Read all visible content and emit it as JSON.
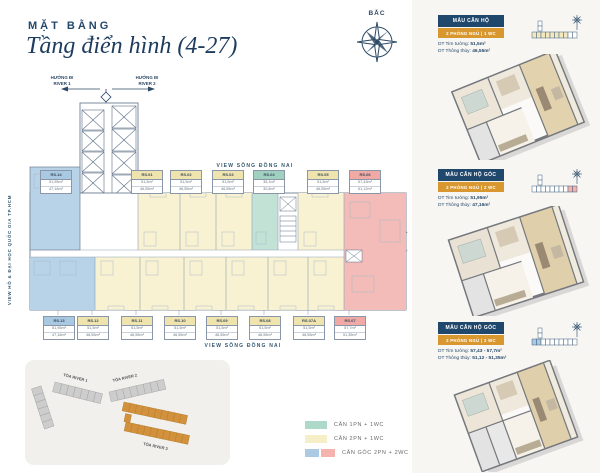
{
  "header": {
    "kicker": "MẶT BẰNG",
    "title": "Tầng điển hình (4-27)",
    "compass_label": "BẮC"
  },
  "plan": {
    "direction_left": {
      "line1": "HƯỚNG ĐI",
      "line2": "RIVER 1"
    },
    "direction_right": {
      "line1": "HƯỚNG ĐI",
      "line2": "RIVER 2"
    },
    "view_top": "VIEW SÔNG ĐỒNG NAI",
    "view_bottom": "VIEW SÔNG ĐỒNG NAI",
    "view_left": "VIEW HỒ & ĐẠI HỌC QUỐC GIA TP.HCM",
    "view_right": "VIEW SÔNG ĐỒNG NAI",
    "top_tags": [
      {
        "code": "RS.14",
        "area1": "51,95m²",
        "area2": "47,16m²",
        "type": "blue"
      },
      {
        "code": "RS.01",
        "area1": "51,5m²",
        "area2": "46,55m²",
        "type": "yellow"
      },
      {
        "code": "RS.02",
        "area1": "51,5m²",
        "area2": "46,55m²",
        "type": "yellow"
      },
      {
        "code": "RS.03",
        "area1": "51,5m²",
        "area2": "46,55m²",
        "type": "yellow"
      },
      {
        "code": "RS.04",
        "area1": "35,1m²",
        "area2": "30,8m²",
        "type": "teal"
      },
      {
        "code": "RS.05",
        "area1": "51,5m²",
        "area2": "46,55m²",
        "type": "yellow"
      },
      {
        "code": "RS.06",
        "area1": "57,43m²",
        "area2": "51,12m²",
        "type": "pink"
      }
    ],
    "bottom_tags": [
      {
        "code": "RS.13",
        "area1": "51,95m²",
        "area2": "47,16m²",
        "type": "blue"
      },
      {
        "code": "RS.12",
        "area1": "51,5m²",
        "area2": "46,55m²",
        "type": "yellow"
      },
      {
        "code": "RS.11",
        "area1": "51,5m²",
        "area2": "46,55m²",
        "type": "yellow"
      },
      {
        "code": "RS.10",
        "area1": "51,5m²",
        "area2": "46,55m²",
        "type": "yellow"
      },
      {
        "code": "RS.09",
        "area1": "51,5m²",
        "area2": "46,55m²",
        "type": "yellow"
      },
      {
        "code": "RS.08",
        "area1": "51,5m²",
        "area2": "46,55m²",
        "type": "yellow"
      },
      {
        "code": "RS.07A",
        "area1": "51,5m²",
        "area2": "46,55m²",
        "type": "yellow"
      },
      {
        "code": "RS.07",
        "area1": "57,7m²",
        "area2": "51,35m²",
        "type": "pink"
      }
    ]
  },
  "site_map": {
    "tower1": "TÒA RIVER 1",
    "tower2": "TÒA RIVER 2",
    "tower3": "TÒA RIVER 3"
  },
  "legend": {
    "items": [
      {
        "label": "CĂN 1PN + 1WC"
      },
      {
        "label": "CĂN 2PN + 1WC"
      },
      {
        "label": "CĂN GÓC 2PN + 2WC"
      }
    ]
  },
  "cards": [
    {
      "title": "MẪU CĂN HỘ",
      "subtitle": "2 PHÒNG NGỦ  |  1 WC",
      "line1_label": "DT Tim tường: ",
      "line1_value": "51,5m²",
      "line2_label": "DT Thông thủy: ",
      "line2_value": "46,55m²"
    },
    {
      "title": "MẪU CĂN HỘ GÓC",
      "subtitle": "2 PHÒNG NGỦ  |  2 WC",
      "line1_label": "DT Tim tường: ",
      "line1_value": "51,95m²",
      "line2_label": "DT Thông thủy: ",
      "line2_value": "47,16m²"
    },
    {
      "title": "MẪU CĂN HỘ GÓC",
      "subtitle": "2 PHÒNG NGỦ  |  2 WC",
      "line1_label": "DT Tim tường: ",
      "line1_value": "57,43 - 57,7m²",
      "line2_label": "DT Thông thủy: ",
      "line2_value": "51,12 - 51,35m²"
    }
  ],
  "colors": {
    "navy": "#20486d",
    "gold": "#d9982f",
    "unit_yellow": "#f8f2d2",
    "unit_teal": "#c2e2d6",
    "unit_blue": "#b8d2e8",
    "unit_pink": "#f3bcb8",
    "tower_highlight_orange": "#d2913c"
  }
}
